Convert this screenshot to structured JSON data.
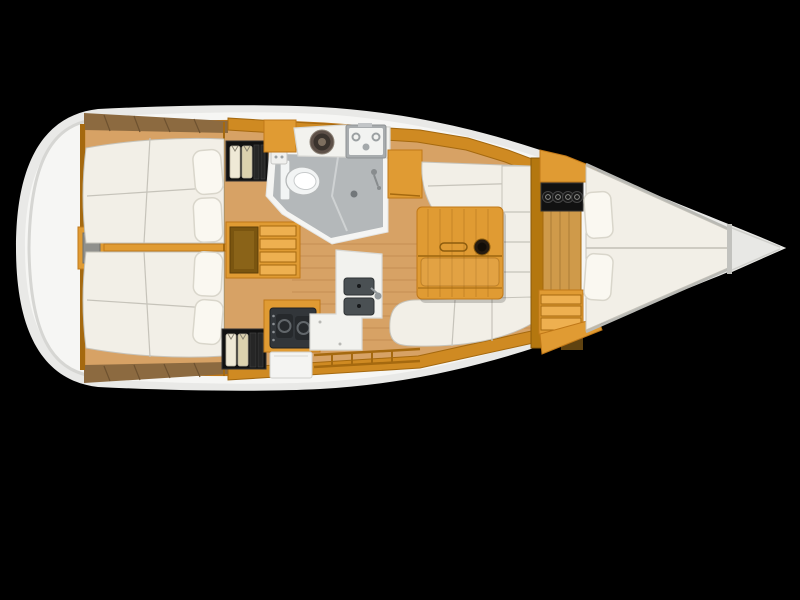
{
  "meta": {
    "title": "sailboat-interior-floorplan-top-view",
    "type": "yacht accommodation plan, bow pointing right, black background",
    "visible_text": "none"
  },
  "colors": {
    "bg": "#000000",
    "hullOuter": "#e9e9e7",
    "hullInner": "#f6f6f4",
    "hullShade": "#d6d6d3",
    "woodPale": "#d7a265",
    "wood": "#e09b33",
    "woodBand": "#cf8a22",
    "woodLight": "#eeb050",
    "woodDark": "#a5690f",
    "woodTrim": "#c07818",
    "deckBrown": "#8c6a40",
    "deckSlat": "#6e5230",
    "mattress": "#f2efe7",
    "mattressSeam": "#c6c3ba",
    "pillow": "#faf8f1",
    "pillowEdge": "#d9d6cb",
    "headWall": "#f5f5f3",
    "headFloor": "#b4b8ba",
    "steel": "#a8acae",
    "applianceDark": "#32363a",
    "sinkDark": "#4a5053",
    "blackBox": "#111111",
    "shirt": "#efe9d6",
    "shirtCream": "#dcd2ae"
  },
  "vessel": {
    "orientation": "bow-right-stern-left",
    "rooms": [
      {
        "name": "aft-cabin-port",
        "features": [
          "double-berth",
          "two-pillows",
          "hanging-wardrobe"
        ]
      },
      {
        "name": "aft-cabin-starboard",
        "features": [
          "double-berth",
          "two-pillows",
          "hanging-wardrobe"
        ]
      },
      {
        "name": "stern-locker",
        "features": [
          "storage-hatch"
        ]
      },
      {
        "name": "companionway",
        "features": [
          "ladder-steps",
          "storage-well"
        ]
      },
      {
        "name": "head",
        "features": [
          "toilet",
          "mini-washbasin",
          "shower-drain",
          "shower-faucet",
          "round-basin",
          "vanity-sink-unit"
        ]
      },
      {
        "name": "galley",
        "features": [
          "two-burner-stove",
          "double-sink",
          "faucet",
          "refrigerator-door",
          "l-shaped-counter",
          "fiddle-rails"
        ]
      },
      {
        "name": "saloon",
        "features": [
          "l-shaped-settee",
          "straight-settee",
          "folding-table",
          "cup-holder",
          "handle-slot",
          "plank-floor"
        ]
      },
      {
        "name": "forward-cabin",
        "features": [
          "v-berth",
          "two-pillows",
          "bottle-rack",
          "step-drawers",
          "door-panel"
        ]
      },
      {
        "name": "bow",
        "features": [
          "anchor-locker-wedge"
        ]
      }
    ]
  }
}
